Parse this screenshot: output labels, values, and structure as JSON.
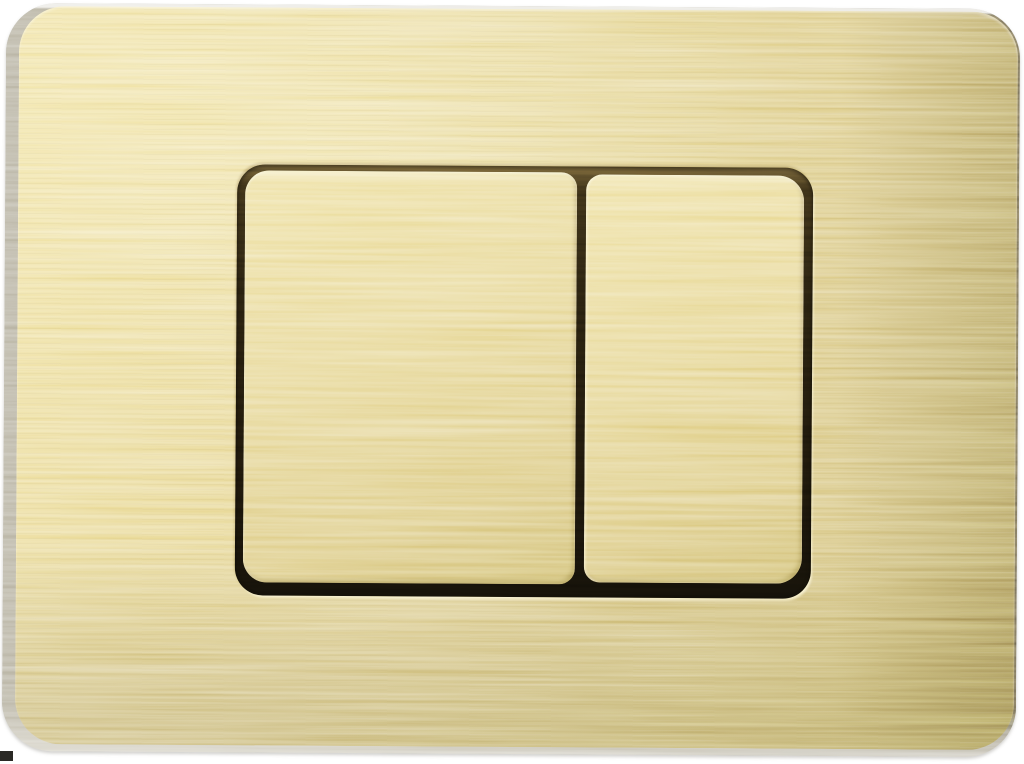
{
  "meta": {
    "domain": "Natural-Image",
    "description": "Product photograph of a brushed gold dual-flush toilet actuator wall plate with two rectangular push buttons, shown at a slight angle on a white background"
  },
  "background": {
    "color": "#ffffff"
  },
  "plate": {
    "name": "dual-flush-actuator-plate",
    "finish": "brushed gold",
    "shape": "rounded rectangle",
    "colors": {
      "gold_highlight": "#f0e19e",
      "gold_base": "#e2d18c",
      "gold_shadow": "#ccb974",
      "side_edge_gray": "#948e78",
      "top_edge_highlight": "#eeede8",
      "recess_shadow": "#1b150a",
      "rim_highlight": "#faf3cd"
    }
  },
  "buttons": {
    "left": {
      "name": "large-flush-button",
      "aria": "Large flush button",
      "shape": "rounded rectangle",
      "relative_size": "large"
    },
    "right": {
      "name": "small-flush-button",
      "aria": "Small flush button",
      "shape": "rounded rectangle",
      "relative_size": "small"
    }
  },
  "artifacts": {
    "bottom_left_mark_color": "#2a2925"
  }
}
